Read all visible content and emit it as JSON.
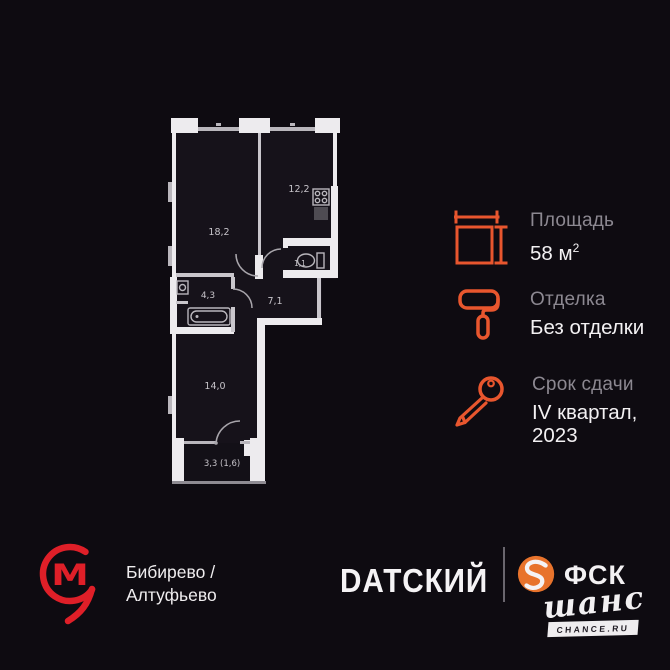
{
  "floor_plan": {
    "labels": {
      "living": "18,2",
      "kitchen": "12,2",
      "wc": "1,1",
      "bathroom": "4,3",
      "hall": "7,1",
      "bedroom": "14,0",
      "balcony": "3,3 (1,6)"
    }
  },
  "details": {
    "area": {
      "label": "Площадь",
      "value": "58 м",
      "sup": "2"
    },
    "finishing": {
      "label": "Отделка",
      "value": "Без отделки"
    },
    "deadline": {
      "label": "Срок сдачи",
      "line1": "IV квартал,",
      "line2": "2023"
    }
  },
  "footer": {
    "metro": {
      "letter": "М",
      "line1": "Бибирево /",
      "line2": "Алтуфьево"
    },
    "brand": "DАТСКИЙ",
    "developer": {
      "name": "ФСК",
      "script": "шанс",
      "site": "CHANCE.RU"
    }
  },
  "colors": {
    "background": "#0E0B11",
    "accent_orange": "#E8562E",
    "fsk_orange": "#E8732C",
    "metro_red": "#DF1F28",
    "wall_white": "#EDEBEE",
    "label_gray": "#8C8891",
    "text_white": "#F3F1F3"
  }
}
